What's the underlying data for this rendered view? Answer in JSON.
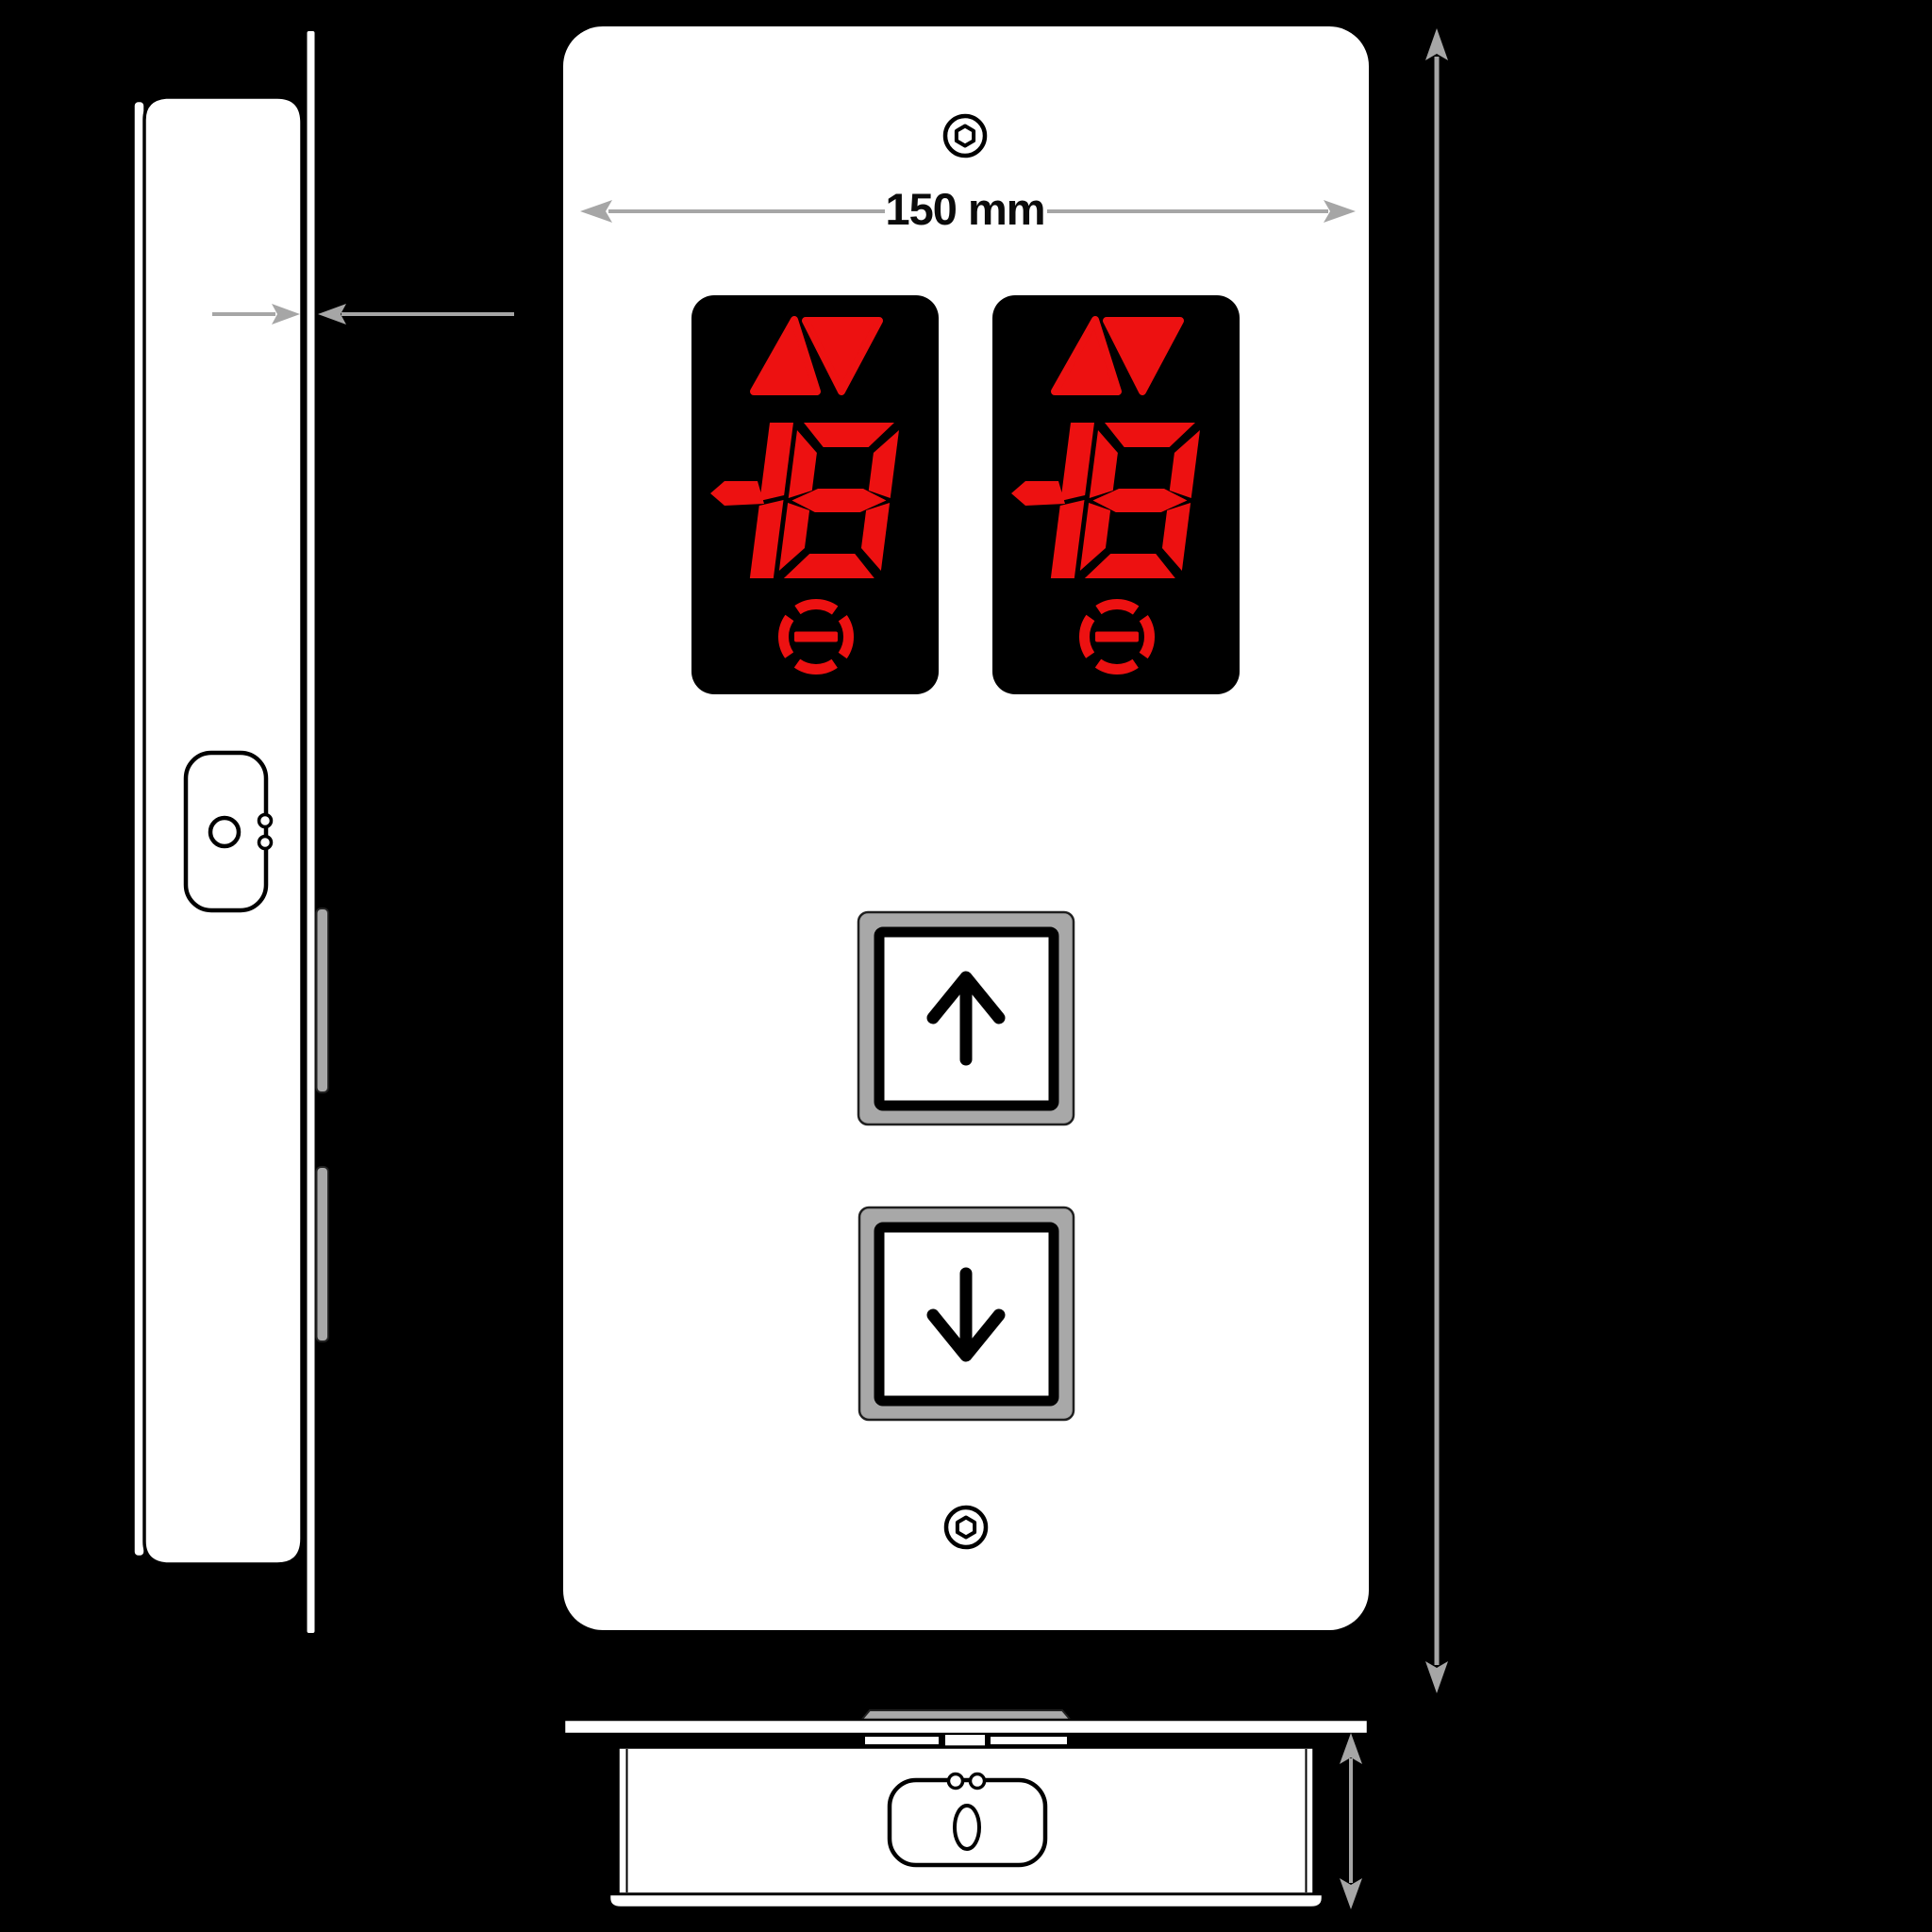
{
  "colors": {
    "background": "#000000",
    "panel_white": "#ffffff",
    "display_black": "#000000",
    "led_red": "#ed1111",
    "button_gray": "#a8a8a8",
    "clip_gray": "#a9a9a9",
    "dimension_gray": "#a6a6a6",
    "outline_black": "#000000"
  },
  "dimensions": {
    "width_label": "150 mm"
  },
  "front_panel": {
    "screw_count": 2,
    "displays": [
      {
        "value": "18",
        "indicators": [
          "up",
          "down"
        ],
        "status_icon": "out-of-service"
      },
      {
        "value": "18",
        "indicators": [
          "up",
          "down"
        ],
        "status_icon": "out-of-service"
      }
    ],
    "buttons": [
      {
        "direction": "up"
      },
      {
        "direction": "down"
      }
    ]
  },
  "views": {
    "left": "side-profile-view",
    "center": "front-view",
    "bottom": "bottom-view"
  }
}
